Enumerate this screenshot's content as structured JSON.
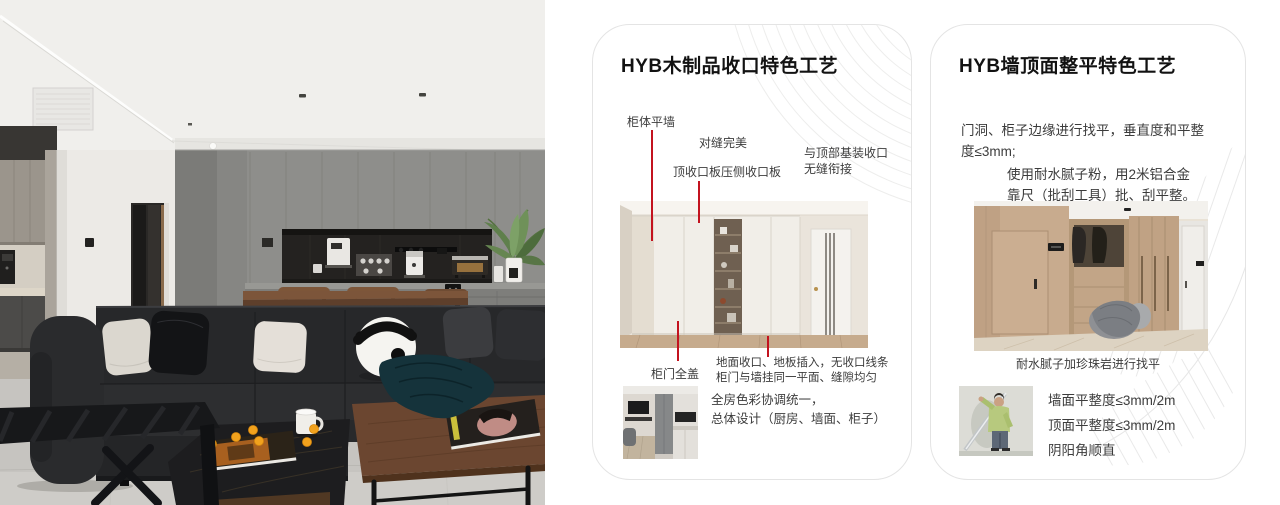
{
  "colors": {
    "accent_red": "#c3131f",
    "card_border": "#e4e4e4",
    "title_color": "#121212",
    "body_color": "#3c3c3c"
  },
  "card_woodwork": {
    "title": "HYB木制品收口特色工艺",
    "callout_cabinet_wall": "柜体平墙",
    "callout_seam_perfect": "对缝完美",
    "callout_top_board": "顶收口板压侧收口板",
    "callout_ceiling_join_line1": "与顶部基装收口",
    "callout_ceiling_join_line2": "无缝衔接",
    "callout_door_full_cover": "柜门全盖",
    "note_floor_line1": "地面收口、地板插入，无收口线条",
    "note_floor_line2": "柜门与墙挂同一平面、缝隙均匀",
    "note_design_line1": "全房色彩协调统一，",
    "note_design_line2": "总体设计（厨房、墙面、柜子）"
  },
  "card_wall": {
    "title": "HYB墙顶面整平特色工艺",
    "para_leveling_line1": "门洞、柜子边缘进行找平，垂直度和平整",
    "para_leveling_line2": "度≤3mm;",
    "para_putty_line1": "使用耐水腻子粉，用2米铝合金",
    "para_putty_line2": "靠尺（批刮工具）批、刮平整。",
    "caption_putty": "耐水腻子加珍珠岩进行找平",
    "spec_wall": "墙面平整度≤3mm/2m",
    "spec_ceiling": "顶面平整度≤3mm/2m",
    "spec_corner": "阴阳角顺直"
  }
}
